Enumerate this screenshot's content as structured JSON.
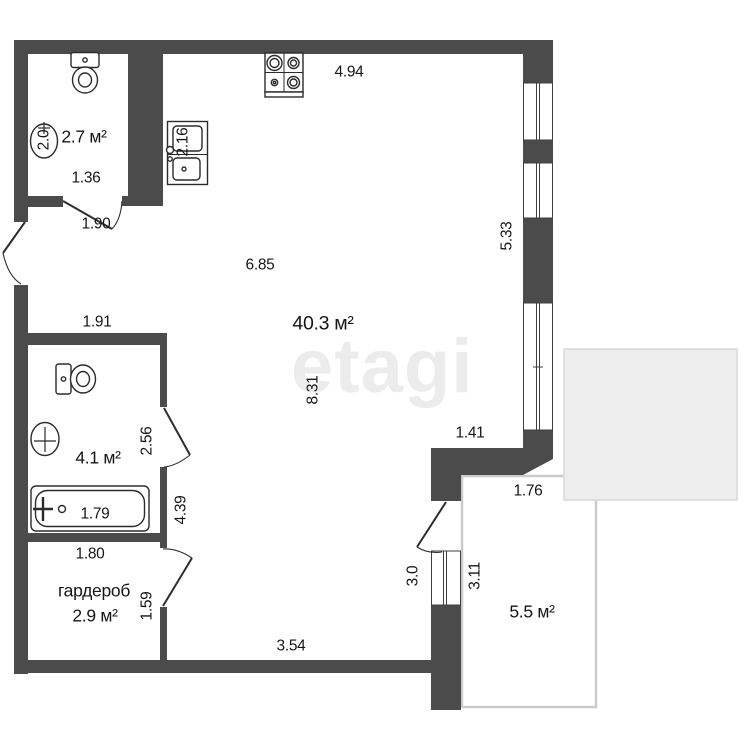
{
  "watermark": "etagi",
  "rooms": {
    "wc": "2.7 м²",
    "living": "40.3 м²",
    "bath": "4.1 м²",
    "wardrobe_name": "гардероб",
    "wardrobe": "2.9 м²",
    "balcony": "5.5 м²"
  },
  "dims": {
    "kitchen_top": "4.94",
    "wc_width": "1.36",
    "wc_door": "1.90",
    "wc_depth": "2.0",
    "kitchen_sink": "2.16",
    "living_width": "6.85",
    "windows_right": "5.33",
    "living_height": "8.31",
    "niche": "1.41",
    "bath_top": "1.91",
    "bath_door": "2.56",
    "bath_width": "1.79",
    "bath_height": "4.39",
    "wardrobe_width": "1.80",
    "wardrobe_door": "1.59",
    "living_bottom": "3.54",
    "balcony_door": "3.0",
    "balcony_window": "3.11",
    "balcony_top": "1.76"
  },
  "colors": {
    "wall": "#4b4b4b",
    "fixture_stroke": "#2b2b2b",
    "balcony_outline": "#cbcbcb",
    "overlay_fill": "#ededed",
    "overlay_border": "#d9d9d9",
    "text": "#161616"
  }
}
